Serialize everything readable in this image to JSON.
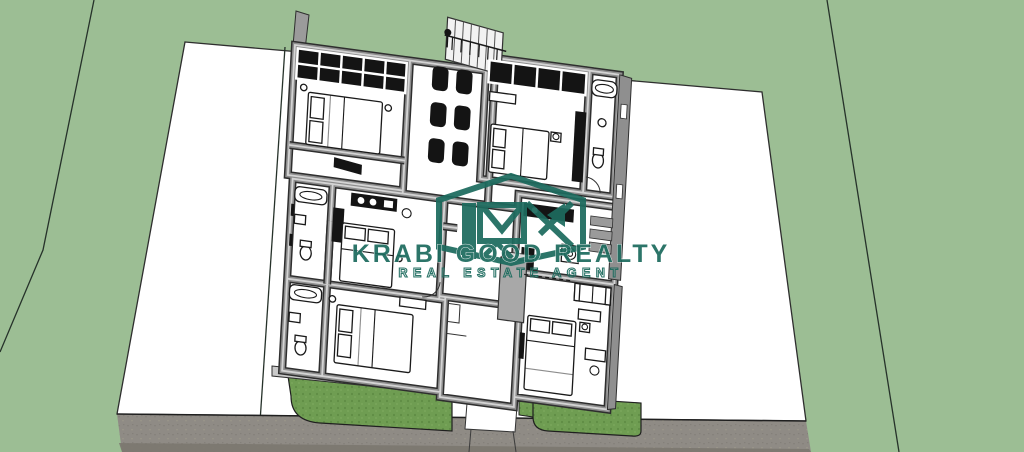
{
  "watermark": {
    "brand": "KRABI GOOD REALTY",
    "tagline": "REAL ESTATE AGENT",
    "monogram": "KR",
    "color": "#1d6b5e"
  },
  "palette": {
    "field_green": "#9cbe94",
    "lawn_green": "#6f9d52",
    "road_gray": "#8f8b85",
    "wall_gray": "#8d8d8d",
    "floor_white": "#ffffff",
    "furniture_black": "#141414"
  },
  "scene": {
    "type": "aerial 3D floor-plan render",
    "features": [
      "single-storey house model with furnished rooms",
      "four bedrooms with double beds",
      "three bathrooms with bathtub, toilet and basin",
      "waiting area with six black armchairs",
      "exterior staircase with railing",
      "kitchen counters and laundry washer",
      "front lawns and white walkway",
      "grey road with driveway gate pad",
      "vacant white plots left and right of the house",
      "green field with surveyed boundary lines"
    ]
  }
}
